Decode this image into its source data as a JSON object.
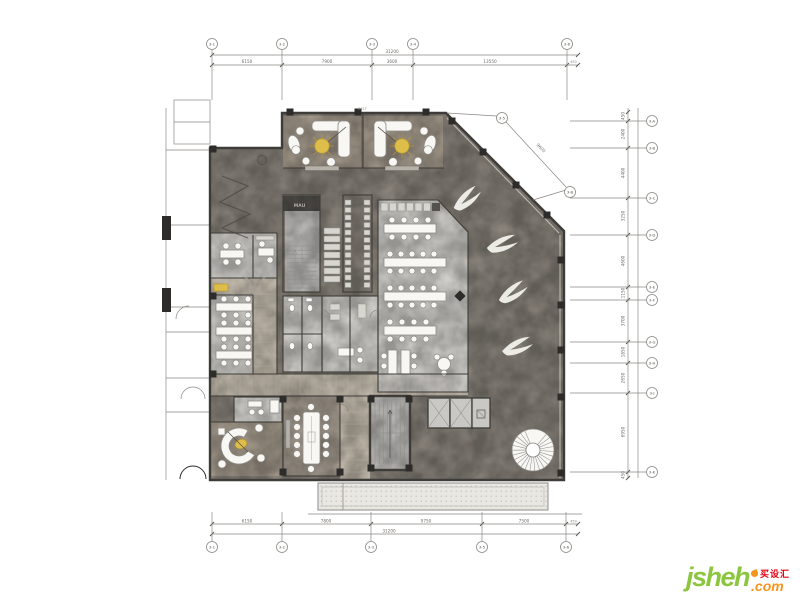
{
  "palette": {
    "bg": "#ffffff",
    "line": "#8a8884",
    "wall": "#3e3c38",
    "floorDark": "#8b857c",
    "floorTan": "#a89d8f",
    "floorLight": "#d7d5d0",
    "wood": "#cdc5b6",
    "woodLine": "#b9b1a1",
    "core": "#c3c2bf",
    "white": "#f8f7f4",
    "gold": "#ddbe4a",
    "goldDeep": "#bb962f",
    "black": "#2d2c2a",
    "canopy": "#e9e7e2",
    "dimText": "#6e6c68",
    "confFloor": "#a59c90",
    "logoGreen": "#8cc63e",
    "logoOrange": "#f7941d",
    "logoRed": "#e60012"
  },
  "plan": {
    "core_unit_label": "MAU",
    "top_wall_tag": "6427"
  },
  "grid": {
    "top": [
      {
        "x": 212,
        "label": "3-1"
      },
      {
        "x": 282,
        "label": "3-2"
      },
      {
        "x": 372,
        "label": "3-3"
      },
      {
        "x": 413,
        "label": "3-4"
      },
      {
        "x": 567,
        "label": "3-6"
      }
    ],
    "bottom": [
      {
        "x": 212,
        "label": "3-1"
      },
      {
        "x": 282,
        "label": "3-2"
      },
      {
        "x": 371,
        "label": "3-3"
      },
      {
        "x": 482,
        "label": "3-5"
      },
      {
        "x": 566,
        "label": "3-6"
      }
    ],
    "right": [
      {
        "y": 121,
        "label": "3-A"
      },
      {
        "y": 148,
        "label": "3-B"
      },
      {
        "y": 198,
        "label": "3-C"
      },
      {
        "y": 235,
        "label": "3-D"
      },
      {
        "y": 287,
        "label": "3-E"
      },
      {
        "y": 300,
        "label": "3-F"
      },
      {
        "y": 342,
        "label": "3-G"
      },
      {
        "y": 363,
        "label": "3-H"
      },
      {
        "y": 393,
        "label": "3-J"
      },
      {
        "y": 472,
        "label": "3-K"
      }
    ],
    "diagonal": [
      {
        "x": 502,
        "y": 118,
        "label": "3-5"
      },
      {
        "x": 570,
        "y": 192,
        "label": "3-B"
      }
    ]
  },
  "dims": {
    "top": {
      "overall": "31200",
      "overall_x": 392,
      "overall_y": 53,
      "end": "450",
      "segments": [
        {
          "x": 247,
          "v": "6150"
        },
        {
          "x": 327,
          "v": "7900"
        },
        {
          "x": 392,
          "v": "3600"
        },
        {
          "x": 490,
          "v": "13550"
        }
      ]
    },
    "bottom": {
      "overall": "31200",
      "overall_x": 389,
      "overall_y": 532.5,
      "end": "450",
      "segments": [
        {
          "x": 247,
          "v": "6150"
        },
        {
          "x": 326,
          "v": "7800"
        },
        {
          "x": 426,
          "v": "9750"
        },
        {
          "x": 524,
          "v": "7500"
        }
      ]
    },
    "right": {
      "segments": [
        {
          "y": 116,
          "v": "450"
        },
        {
          "y": 134,
          "v": "2400"
        },
        {
          "y": 173,
          "v": "4400"
        },
        {
          "y": 216,
          "v": "3250"
        },
        {
          "y": 261,
          "v": "4600"
        },
        {
          "y": 293,
          "v": "1150"
        },
        {
          "y": 321,
          "v": "3700"
        },
        {
          "y": 352,
          "v": "1850"
        },
        {
          "y": 378,
          "v": "2650"
        },
        {
          "y": 432,
          "v": "6950"
        },
        {
          "y": 475,
          "v": "450"
        }
      ]
    },
    "diagonal": {
      "v": "9600"
    }
  },
  "watermark": {
    "brand": "jsheh",
    "tld": ".com",
    "cn": "买设汇"
  }
}
